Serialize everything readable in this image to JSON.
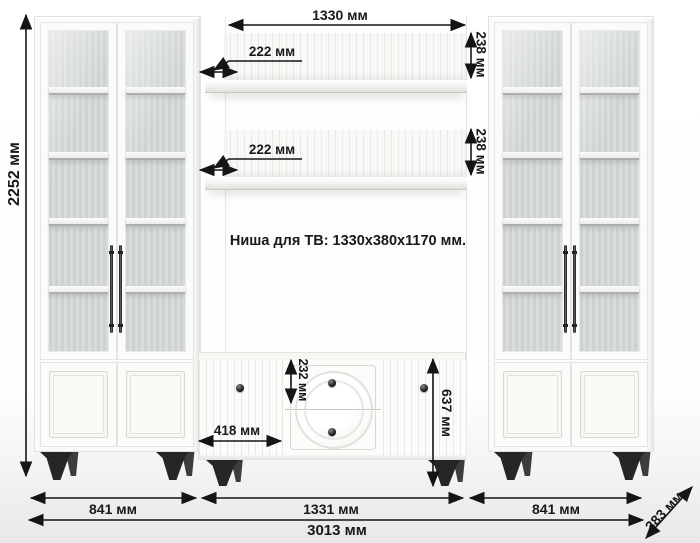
{
  "diagram": {
    "note": "Ниша для ТВ: 1330x380x1170 мм."
  },
  "dimensions": {
    "total_height": "2252 мм",
    "niche_width": "1330 мм",
    "shelf_top_depth": "222 мм",
    "shelf_top_height": "238 мм",
    "shelf_bottom_depth": "222 мм",
    "shelf_bottom_height": "238 мм",
    "drawer_height": "232 мм",
    "stand_door_width": "418 мм",
    "stand_height": "637 мм",
    "left_cabinet_width": "841 мм",
    "stand_width": "1331 мм",
    "right_cabinet_width": "841 мм",
    "total_width": "3013 мм",
    "total_depth": "383 мм"
  },
  "colors": {
    "dimension_ink": "#191919",
    "furniture_white": "#fbfbf9",
    "glass_gray": "#ccd2d1",
    "legs_black": "#262626",
    "background": "#ffffff"
  }
}
